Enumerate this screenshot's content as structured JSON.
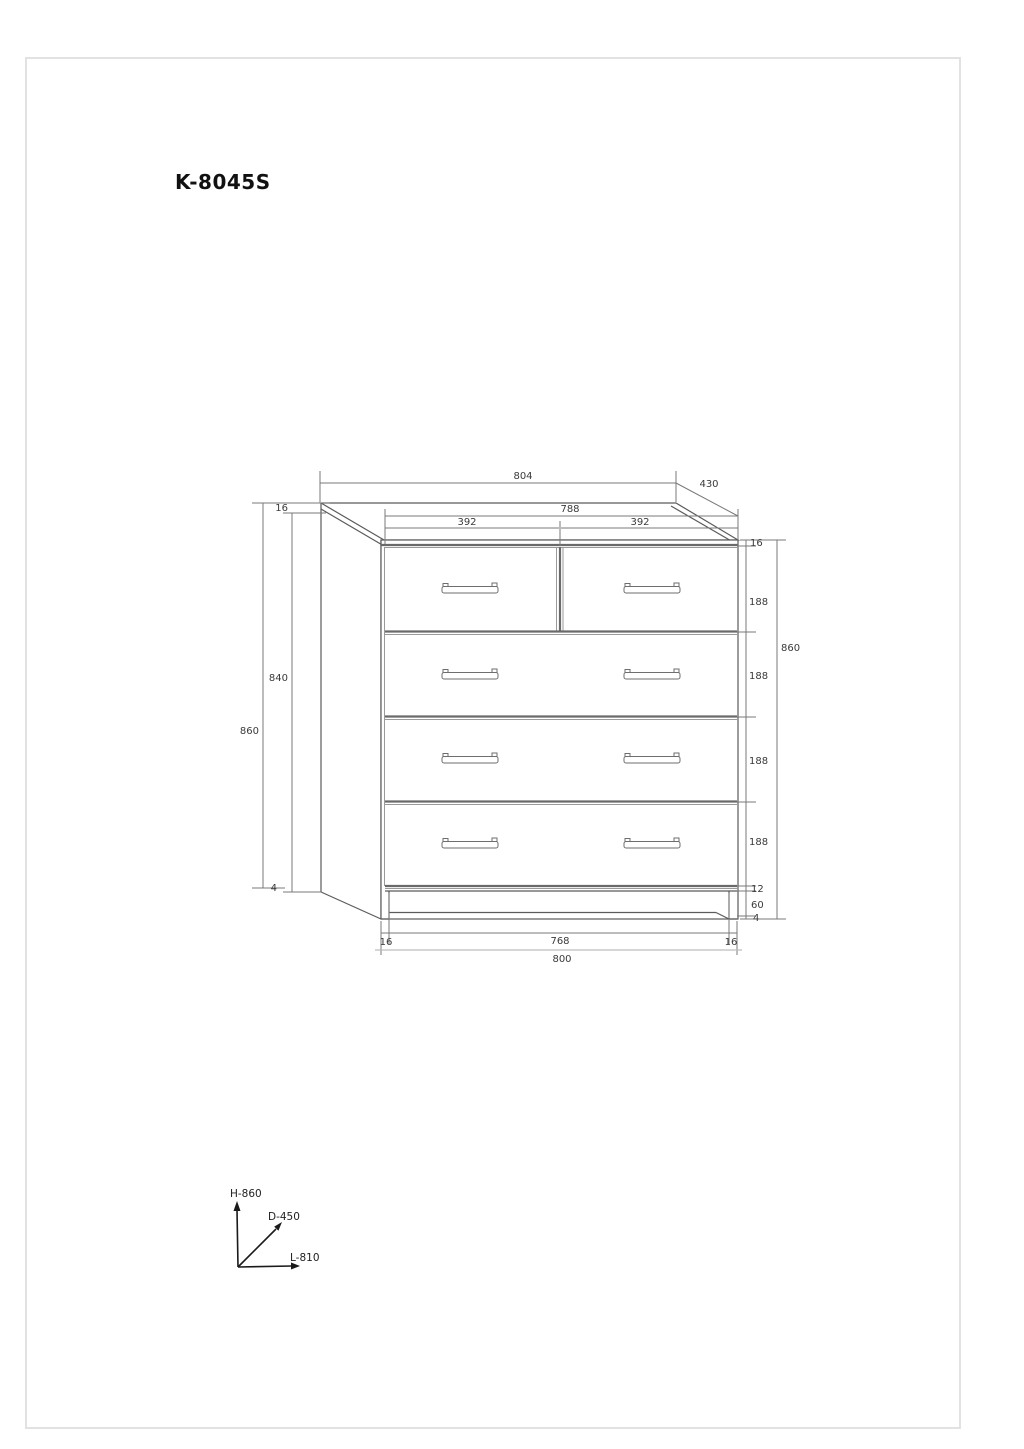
{
  "title": "K-8045S",
  "colors": {
    "ink": "#5b5b5b",
    "dim_text": "#3a3a3a",
    "light_line": "#bdbdbd"
  },
  "dims": {
    "top_panel_width": "804",
    "depth": "430",
    "front_width": "788",
    "left_drawer_width": "392",
    "right_drawer_width": "392",
    "top_thickness_left": "16",
    "side_panel_height": "840",
    "overall_height_left": "860",
    "back_foot_height": "4",
    "top_thickness_right": "16",
    "drawer_heights": [
      "188",
      "188",
      "188",
      "188"
    ],
    "under_drawer_gap": "12",
    "plinth_height": "60",
    "front_foot_height": "4",
    "overall_height_right": "860",
    "left_leg_width": "16",
    "inner_bottom_width": "768",
    "right_leg_width": "16",
    "overall_width": "800"
  },
  "axes": {
    "height_label": "H-860",
    "depth_label": "D-450",
    "length_label": "L-810"
  }
}
